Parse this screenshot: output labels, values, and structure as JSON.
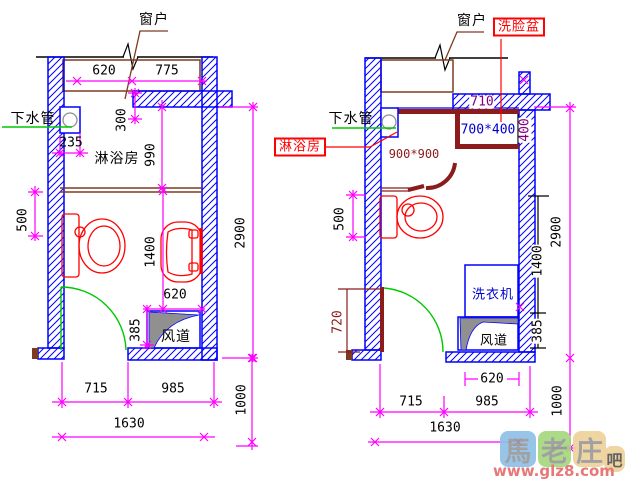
{
  "drawing_title": "bathroom layout plan comparison",
  "colors": {
    "wall": "#0000ff",
    "dimension": "#ff00ff",
    "fixture": "#ff0000",
    "door": "#00c800",
    "window": "#7e3a21",
    "shower_enclosure": "#8c1c1c",
    "duct_fill": "#909090",
    "text_blue": "#0000cc",
    "text_purple": "#800080",
    "watermark_url_color": "#e87878"
  },
  "left_plan": {
    "labels": {
      "window": "窗户",
      "drain_pipe": "下水管",
      "shower_room": "淋浴房",
      "air_duct": "风道"
    },
    "dims": {
      "win_a": "620",
      "win_b": "775",
      "drain_w": "235",
      "drain_off": "300",
      "shower_depth": "990",
      "side": "500",
      "room_h": "2900",
      "toilet_span": "1400",
      "duct_w": "620",
      "duct_h": "385",
      "bot_a": "715",
      "bot_b": "985",
      "total": "1630",
      "below": "1000"
    }
  },
  "right_plan": {
    "labels": {
      "window": "窗户",
      "wash_basin": "洗脸盆",
      "drain_pipe": "下水管",
      "shower_room": "淋浴房",
      "shower_size": "900*900",
      "basin_size": "700*400",
      "wall_seg": "710",
      "basin_depth": "400",
      "washer": "洗衣机",
      "air_duct": "风道"
    },
    "dims": {
      "side": "500",
      "door": "720",
      "room_h": "2900",
      "toilet_span": "1400",
      "duct_h": "385",
      "duct_w": "620",
      "bot_a": "715",
      "bot_b": "985",
      "total": "1630",
      "below": "1000"
    }
  },
  "watermark": {
    "tiles": [
      {
        "char": "馬",
        "color": "#8fc1e8"
      },
      {
        "char": "老",
        "color": "#a5d97e"
      },
      {
        "char": "庄",
        "color": "#eed29a"
      },
      {
        "char": "吧",
        "color": "#eed29a"
      }
    ],
    "url": "www.glz8.com"
  }
}
